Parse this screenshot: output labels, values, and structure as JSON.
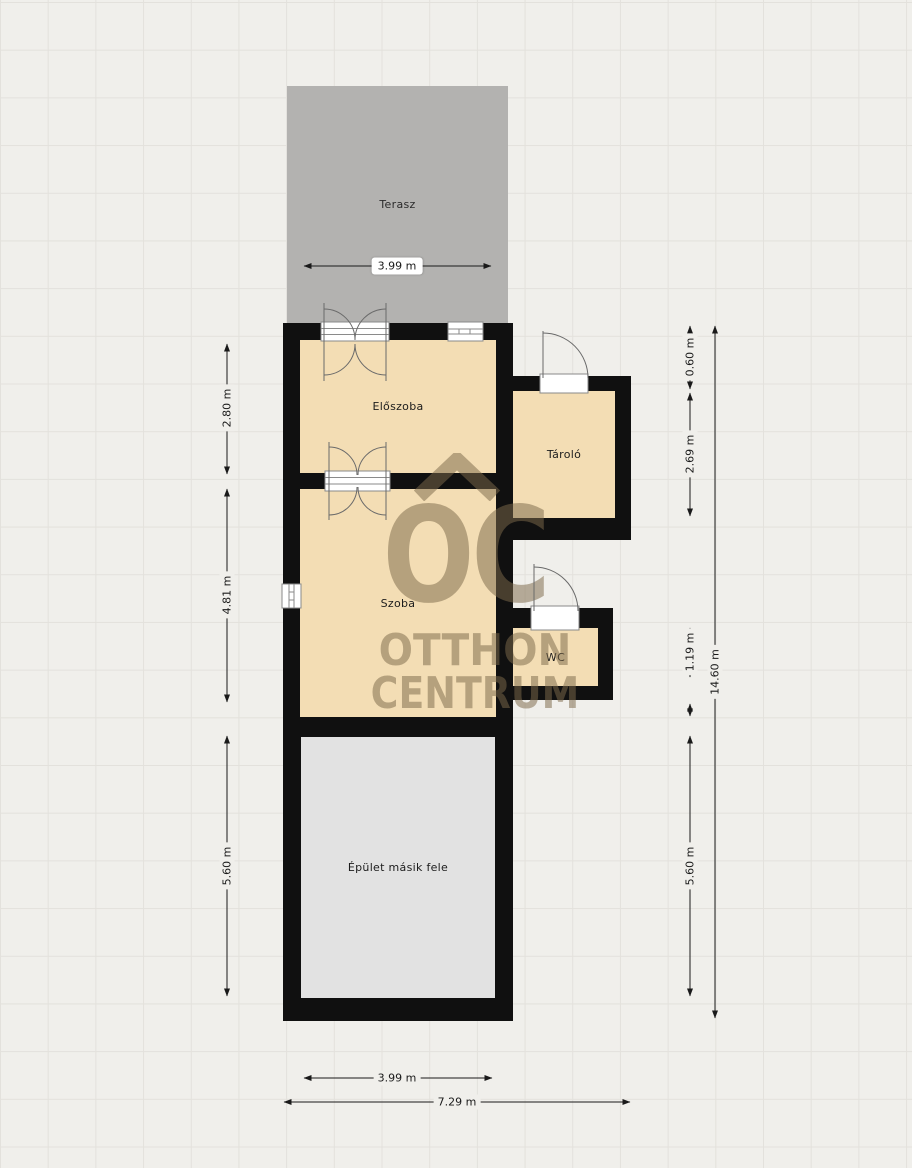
{
  "plan": {
    "title": "floor-plan",
    "rooms": {
      "terasz": "Terasz",
      "eloszoba": "Előszoba",
      "tarolo": "Tároló",
      "szoba": "Szoba",
      "wc": "WC",
      "epulet_masik_fele": "Épület másik fele"
    },
    "dims": {
      "terrace_width": "3.99 m",
      "left_eloszoba": "2.80 m",
      "left_szoba": "4.81 m",
      "left_lower": "5.60 m",
      "right_offset": "0.60 m",
      "right_tarolo": "2.69 m",
      "right_wc": "1.19 m",
      "right_lower": "5.60 m",
      "right_total": "14.60 m",
      "bottom_inner": "3.99 m",
      "bottom_total": "7.29 m"
    },
    "watermark": {
      "monogram": "OC",
      "line1": "OTTHON",
      "line2": "CENTRUM"
    },
    "colors": {
      "background": "#f0efeb",
      "grid_line": "#e3e1dc",
      "wall": "#101010",
      "room_fill": "#f3ddb4",
      "terrace_fill": "#b3b2b0",
      "other_half_fill": "#e2e2e2",
      "watermark": "#7d6a4a",
      "dimension_text": "#1a1a1a"
    }
  }
}
